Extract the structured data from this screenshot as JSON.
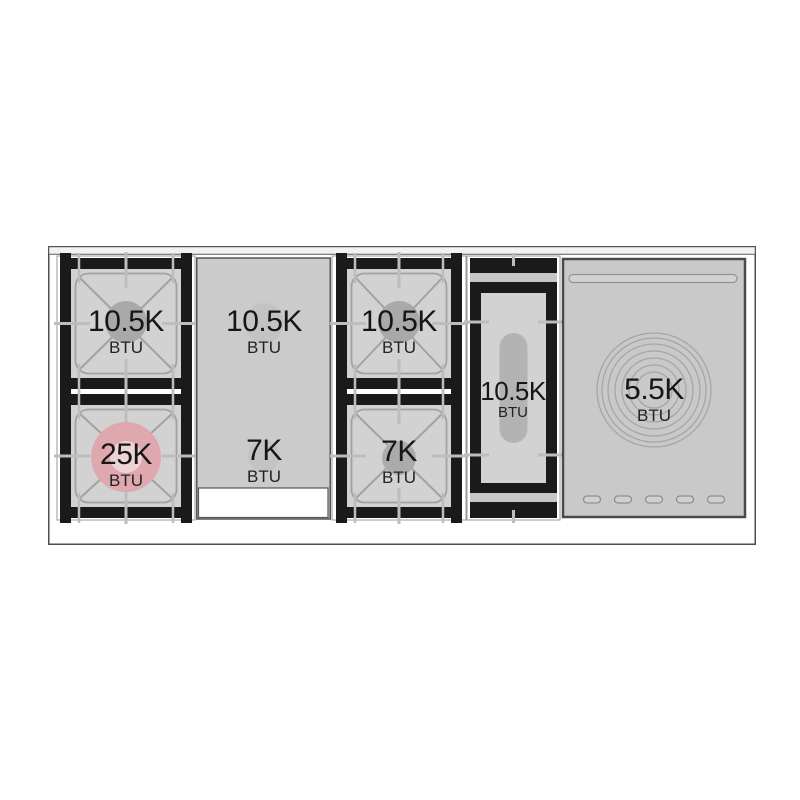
{
  "diagram": {
    "kind": "range-cooktop-top-view",
    "labels": [
      {
        "burner": "left-rear",
        "value": "10.5K",
        "unit": "BTU"
      },
      {
        "burner": "left-front",
        "value": "25K",
        "unit": "BTU"
      },
      {
        "burner": "griddle-rear",
        "value": "10.5K",
        "unit": "BTU"
      },
      {
        "burner": "griddle-front",
        "value": "7K",
        "unit": "BTU"
      },
      {
        "burner": "center-rear",
        "value": "10.5K",
        "unit": "BTU"
      },
      {
        "burner": "center-front",
        "value": "7K",
        "unit": "BTU"
      },
      {
        "burner": "oval",
        "value": "10.5K",
        "unit": "BTU"
      },
      {
        "burner": "simmer-plate",
        "value": "5.5K",
        "unit": "BTU"
      }
    ],
    "colors": {
      "highlight_burner": "#dfa8ae",
      "highlight_burner_center": "#edd2d6",
      "grate_black": "#1a1a1a",
      "surface_gray": "#d2d2d2",
      "panel_gray": "#c9c9c9"
    }
  }
}
